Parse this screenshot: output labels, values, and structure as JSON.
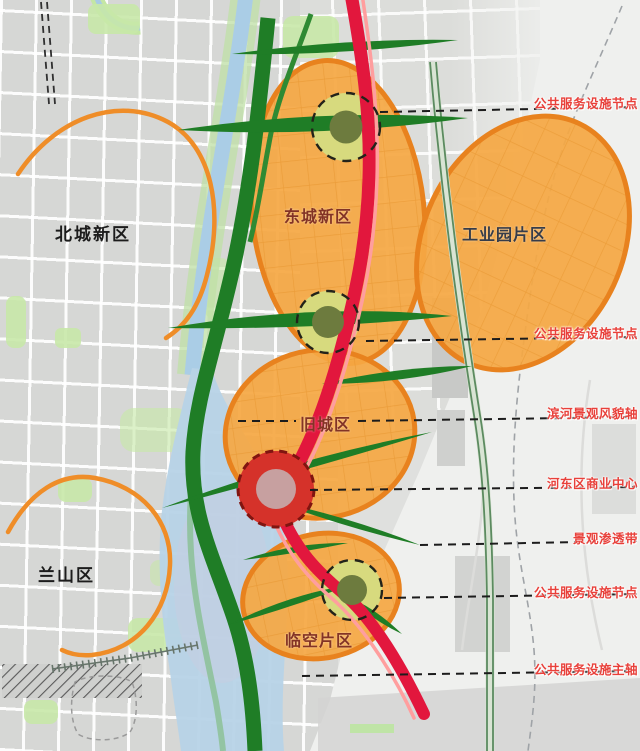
{
  "districts": {
    "north_city": "北城新区",
    "lanshan": "兰山区"
  },
  "zones": {
    "east_city": "东城新区",
    "industrial_park": "工业园片区",
    "old_city": "旧城区",
    "airport_area": "临空片区"
  },
  "annotations": {
    "node1": "公共服务设施节点",
    "node2": "公共服务设施节点",
    "riverside_axis": "滨河景观风貌轴",
    "commercial_center": "河东区商业中心",
    "landscape_belt": "景观渗透带",
    "node3": "公共服务设施节点",
    "main_axis": "公共服务设施主轴"
  },
  "colors": {
    "zone_fill": "#f5a844",
    "zone_border": "#e8821e",
    "corridor_green": "#1f7d26",
    "axis_red": "#e2173d",
    "node_fill": "#d7da7e",
    "node_core": "#6d7b3e",
    "center_red": "#d5322a",
    "center_core": "#c7a0a0",
    "annotation_red": "#e8403a",
    "river_blue": "#b7d3e7",
    "ring_orange": "#ef8d28"
  }
}
